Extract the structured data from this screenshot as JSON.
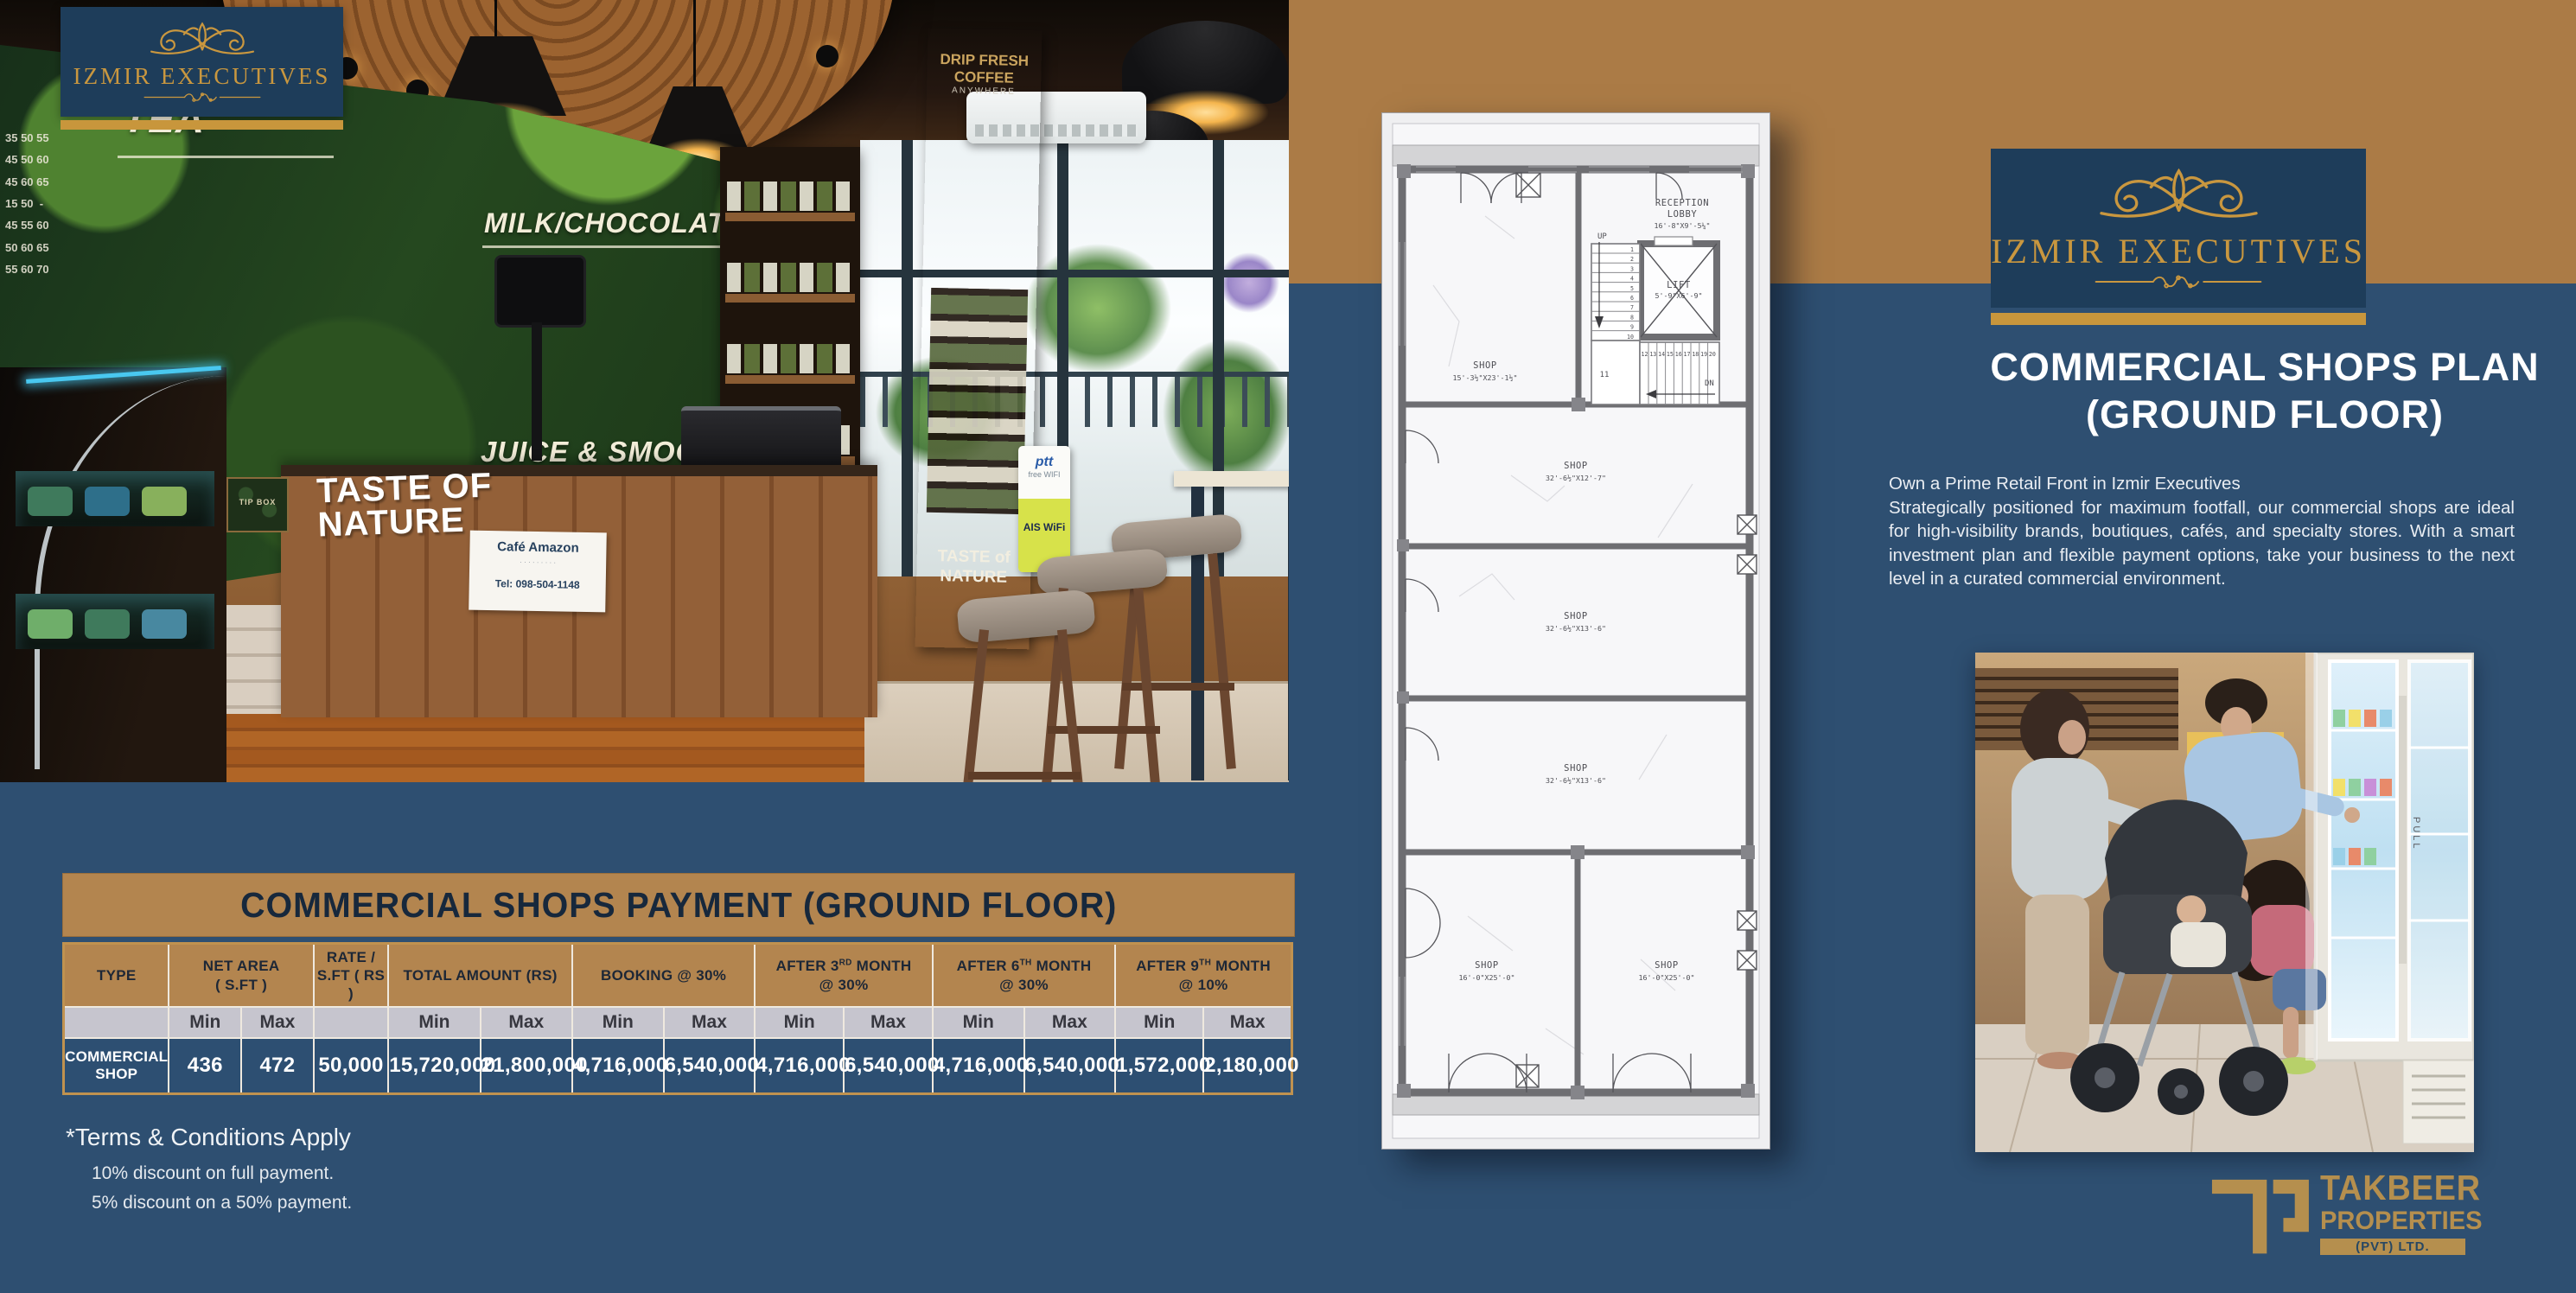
{
  "colors": {
    "navy_background": "#2e4f71",
    "navy_dark": "#1e3d5a",
    "gold_band": "#ab7b46",
    "gold_header": "#b3854f",
    "gold_bright": "#c8963c",
    "logo_gold": "#c9973f",
    "table_subheader_gray": "#c6c5ce",
    "white": "#ffffff"
  },
  "brand": {
    "logo_text": "IZMIR EXECUTIVES"
  },
  "cafe_photo": {
    "menu_tea": "TEA",
    "menu_milk": "MILK/CHOCOLATE",
    "menu_additional": "ADDITIONAL",
    "menu_juice": "JUICE & SMOOTHIES",
    "menu_price_sample": "35 50 55\n45 50 60\n45 60 65\n15 50  -\n45 55 60\n50 60 65\n55 60 70",
    "counter_sign_line1": "TASTE OF",
    "counter_sign_line2": "NATURE",
    "stand_sign_line1": "TASTE of",
    "stand_sign_line2": "NATURE",
    "drip_line1": "DRIP FRESH",
    "drip_line2": "COFFEE",
    "drip_line3": "ANYWHERE",
    "ptt": "ptt",
    "ptt_sub": "free WIFI",
    "ais": "AIS WiFi",
    "tip_box": "TIP BOX",
    "paper_title": "Café Amazon",
    "paper_tel": "Tel: 098-504-1148"
  },
  "payment": {
    "title": "COMMERCIAL SHOPS PAYMENT (GROUND FLOOR)",
    "columns": [
      {
        "lines": [
          "TYPE"
        ],
        "sub": [
          ""
        ]
      },
      {
        "lines": [
          "NET AREA",
          "( S.FT )"
        ],
        "sub": [
          "Min",
          "Max"
        ]
      },
      {
        "lines": [
          "RATE /",
          "S.FT ( RS )"
        ],
        "sub": [
          ""
        ]
      },
      {
        "lines": [
          "TOTAL AMOUNT (RS)"
        ],
        "sub": [
          "Min",
          "Max"
        ]
      },
      {
        "lines": [
          "BOOKING @ 30%"
        ],
        "sub": [
          "Min",
          "Max"
        ]
      },
      {
        "lines": [
          "AFTER 3^RD^ MONTH",
          "@ 30%"
        ],
        "sub": [
          "Min",
          "Max"
        ]
      },
      {
        "lines": [
          "AFTER 6^TH^ MONTH",
          "@ 30%"
        ],
        "sub": [
          "Min",
          "Max"
        ]
      },
      {
        "lines": [
          "AFTER 9^TH^ MONTH",
          "@ 10%"
        ],
        "sub": [
          "Min",
          "Max"
        ]
      }
    ],
    "row": [
      "COMMERCIAL SHOP",
      "436",
      "472",
      "50,000",
      "15,720,000",
      "21,800,000",
      "4,716,000",
      "6,540,000",
      "4,716,000",
      "6,540,000",
      "4,716,000",
      "6,540,000",
      "1,572,000",
      "2,180,000"
    ],
    "terms_title": "*Terms & Conditions Apply",
    "terms": [
      "10% discount on full payment.",
      "5% discount on a 50% payment."
    ]
  },
  "floor_plan": {
    "shop_top": {
      "name": "SHOP",
      "dims": "15'-3½\"X23'-1½\""
    },
    "reception": {
      "name1": "RECEPTION",
      "name2": "LOBBY",
      "dims": "16'-8\"X9'-5¼\""
    },
    "lift": {
      "name": "LIFT",
      "dims": "5'-9\"X6'-9\""
    },
    "shop_a": {
      "name": "SHOP",
      "dims": "32'-6½\"X12'-7\""
    },
    "shop_b": {
      "name": "SHOP",
      "dims": "32'-6½\"X13'-6\""
    },
    "shop_c": {
      "name": "SHOP",
      "dims": "32'-6½\"X13'-6\""
    },
    "shop_bl": {
      "name": "SHOP",
      "dims": "16'-0\"X25'-0\""
    },
    "shop_br": {
      "name": "SHOP",
      "dims": "16'-0\"X25'-0\""
    },
    "up_label": "UP",
    "dn_label": "DN",
    "landing": "11",
    "stairs_up": [
      "1",
      "2",
      "3",
      "4",
      "5",
      "6",
      "7",
      "8",
      "9",
      "10"
    ],
    "stairs_dn": [
      "12",
      "13",
      "14",
      "15",
      "16",
      "17",
      "18",
      "19",
      "20"
    ]
  },
  "right_panel": {
    "title_line1": "COMMERCIAL SHOPS PLAN",
    "title_line2": "(GROUND FLOOR)",
    "intro": "Own a Prime Retail Front in Izmir Executives",
    "body": "Strategically positioned for maximum footfall, our commercial shops are ideal for high-visibility brands, boutiques, cafés, and specialty stores. With a smart investment plan and flexible payment options, take your business to the next level in a curated commercial environment.",
    "family_photo_label": "PULL",
    "takbeer_line1": "TAKBEER",
    "takbeer_line2": "PROPERTIES",
    "takbeer_line3": "(PVT) LTD."
  }
}
